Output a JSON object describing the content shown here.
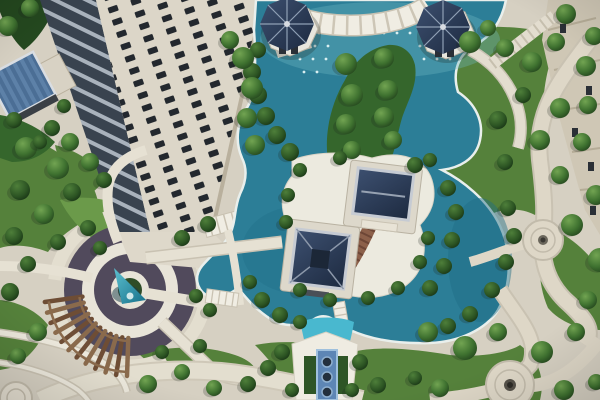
{
  "meta": {
    "description": "Aerial photograph of a residential complex courtyard with teal ornamental ponds, two navy-roofed pavilions on a central island, two octagonal gazebos, a circular garden plaza with a teal cone fountain, a curved wooden pergola, winding stone walkways and a cream high-rise tower at the upper left"
  },
  "palette": {
    "paving": "#d6d0c2",
    "paving_light": "#eceadf",
    "paving_band": "#c9c2b2",
    "paving_dark": "#b5ac99",
    "lawn": "#55813b",
    "lawn_light": "#6b9a4a",
    "foliage_dark": "#24481f",
    "foliage": "#35662c",
    "plant_purple": "#514a5c",
    "plant_inner": "#2f4d28",
    "water": "#2c7e97",
    "water_deep": "#1f6c86",
    "water_light": "#6fb6c2",
    "water_cyan": "#49b8cf",
    "coping": "#e9efec",
    "roof_navy": "#26354e",
    "roof_ridge": "#c6cbd3",
    "building_face": "#dcd6c8",
    "building_side": "#cfc7b5",
    "window": "#23282e",
    "balcony_glass": "#39434f",
    "balcony_slab": "#a9b2bc",
    "panel_blue": "#5d81a8",
    "panel_blue_dark": "#4b6e95",
    "wood": "#6e4d35",
    "wood_light": "#8a6a4c",
    "terracotta": "#8c604a",
    "step_shadow": "#6d4636",
    "feature_blue": "#5d86b5",
    "feature_rim": "#9fc0dd",
    "pot_dark": "#23303e",
    "inset_green": "#2e5526",
    "shadow": "#1c241c"
  },
  "scene": {
    "trees": [
      {
        "x": 346,
        "y": 64,
        "r": 11,
        "k": "t"
      },
      {
        "x": 384,
        "y": 58,
        "r": 10,
        "k": "t"
      },
      {
        "x": 352,
        "y": 95,
        "r": 11,
        "k": "t"
      },
      {
        "x": 388,
        "y": 90,
        "r": 10,
        "k": "t"
      },
      {
        "x": 346,
        "y": 124,
        "r": 10,
        "k": "t"
      },
      {
        "x": 384,
        "y": 117,
        "r": 10,
        "k": "t"
      },
      {
        "x": 352,
        "y": 150,
        "r": 9,
        "k": "t"
      },
      {
        "x": 393,
        "y": 140,
        "r": 9,
        "k": "t"
      },
      {
        "x": 258,
        "y": 50,
        "r": 8,
        "k": "b"
      },
      {
        "x": 252,
        "y": 72,
        "r": 9,
        "k": "b"
      },
      {
        "x": 258,
        "y": 95,
        "r": 9,
        "k": "b"
      },
      {
        "x": 266,
        "y": 116,
        "r": 9,
        "k": "b"
      },
      {
        "x": 277,
        "y": 135,
        "r": 9,
        "k": "b"
      },
      {
        "x": 290,
        "y": 152,
        "r": 9,
        "k": "b"
      },
      {
        "x": 243,
        "y": 58,
        "r": 11,
        "k": "t"
      },
      {
        "x": 252,
        "y": 88,
        "r": 11,
        "k": "t"
      },
      {
        "x": 247,
        "y": 118,
        "r": 10,
        "k": "t"
      },
      {
        "x": 255,
        "y": 145,
        "r": 10,
        "k": "t"
      },
      {
        "x": 230,
        "y": 40,
        "r": 9,
        "k": "t"
      },
      {
        "x": 470,
        "y": 42,
        "r": 11,
        "k": "t"
      },
      {
        "x": 488,
        "y": 28,
        "r": 8,
        "k": "t"
      },
      {
        "x": 505,
        "y": 48,
        "r": 9,
        "k": "t"
      },
      {
        "x": 532,
        "y": 62,
        "r": 10,
        "k": "t"
      },
      {
        "x": 556,
        "y": 42,
        "r": 9,
        "k": "t"
      },
      {
        "x": 586,
        "y": 66,
        "r": 10,
        "k": "t"
      },
      {
        "x": 523,
        "y": 95,
        "r": 8,
        "k": "b"
      },
      {
        "x": 560,
        "y": 108,
        "r": 10,
        "k": "t"
      },
      {
        "x": 498,
        "y": 120,
        "r": 9,
        "k": "b"
      },
      {
        "x": 540,
        "y": 140,
        "r": 10,
        "k": "t"
      },
      {
        "x": 582,
        "y": 142,
        "r": 9,
        "k": "t"
      },
      {
        "x": 505,
        "y": 162,
        "r": 8,
        "k": "b"
      },
      {
        "x": 560,
        "y": 175,
        "r": 9,
        "k": "t"
      },
      {
        "x": 566,
        "y": 14,
        "r": 10,
        "k": "t"
      },
      {
        "x": 594,
        "y": 36,
        "r": 9,
        "k": "t"
      },
      {
        "x": 588,
        "y": 105,
        "r": 9,
        "k": "t"
      },
      {
        "x": 596,
        "y": 195,
        "r": 10,
        "k": "t"
      },
      {
        "x": 572,
        "y": 225,
        "r": 11,
        "k": "t"
      },
      {
        "x": 600,
        "y": 260,
        "r": 12,
        "k": "t"
      },
      {
        "x": 588,
        "y": 300,
        "r": 9,
        "k": "t"
      },
      {
        "x": 448,
        "y": 188,
        "r": 8,
        "k": "b"
      },
      {
        "x": 456,
        "y": 212,
        "r": 8,
        "k": "b"
      },
      {
        "x": 452,
        "y": 240,
        "r": 8,
        "k": "b"
      },
      {
        "x": 444,
        "y": 266,
        "r": 8,
        "k": "b"
      },
      {
        "x": 430,
        "y": 288,
        "r": 8,
        "k": "b"
      },
      {
        "x": 508,
        "y": 208,
        "r": 8,
        "k": "b"
      },
      {
        "x": 514,
        "y": 236,
        "r": 8,
        "k": "b"
      },
      {
        "x": 506,
        "y": 262,
        "r": 8,
        "k": "b"
      },
      {
        "x": 492,
        "y": 290,
        "r": 8,
        "k": "b"
      },
      {
        "x": 470,
        "y": 314,
        "r": 8,
        "k": "b"
      },
      {
        "x": 448,
        "y": 326,
        "r": 8,
        "k": "b"
      },
      {
        "x": 300,
        "y": 170,
        "r": 7,
        "k": "b"
      },
      {
        "x": 288,
        "y": 195,
        "r": 7,
        "k": "b"
      },
      {
        "x": 286,
        "y": 222,
        "r": 7,
        "k": "b"
      },
      {
        "x": 300,
        "y": 290,
        "r": 7,
        "k": "b"
      },
      {
        "x": 330,
        "y": 300,
        "r": 7,
        "k": "b"
      },
      {
        "x": 368,
        "y": 298,
        "r": 7,
        "k": "b"
      },
      {
        "x": 398,
        "y": 288,
        "r": 7,
        "k": "b"
      },
      {
        "x": 420,
        "y": 262,
        "r": 7,
        "k": "b"
      },
      {
        "x": 428,
        "y": 238,
        "r": 7,
        "k": "b"
      },
      {
        "x": 340,
        "y": 158,
        "r": 7,
        "k": "b"
      },
      {
        "x": 415,
        "y": 165,
        "r": 8,
        "k": "b"
      },
      {
        "x": 430,
        "y": 160,
        "r": 7,
        "k": "b"
      },
      {
        "x": 262,
        "y": 300,
        "r": 8,
        "k": "b"
      },
      {
        "x": 280,
        "y": 315,
        "r": 8,
        "k": "b"
      },
      {
        "x": 300,
        "y": 322,
        "r": 7,
        "k": "b"
      },
      {
        "x": 250,
        "y": 282,
        "r": 7,
        "k": "b"
      },
      {
        "x": 210,
        "y": 310,
        "r": 7,
        "k": "b"
      },
      {
        "x": 196,
        "y": 296,
        "r": 7,
        "k": "b"
      },
      {
        "x": 428,
        "y": 332,
        "r": 10,
        "k": "t"
      },
      {
        "x": 465,
        "y": 348,
        "r": 12,
        "k": "t"
      },
      {
        "x": 498,
        "y": 332,
        "r": 9,
        "k": "t"
      },
      {
        "x": 542,
        "y": 352,
        "r": 11,
        "k": "t"
      },
      {
        "x": 576,
        "y": 332,
        "r": 9,
        "k": "t"
      },
      {
        "x": 564,
        "y": 390,
        "r": 10,
        "k": "t"
      },
      {
        "x": 596,
        "y": 382,
        "r": 8,
        "k": "t"
      },
      {
        "x": 440,
        "y": 388,
        "r": 9,
        "k": "t"
      },
      {
        "x": 415,
        "y": 378,
        "r": 7,
        "k": "b"
      },
      {
        "x": 282,
        "y": 352,
        "r": 8,
        "k": "b"
      },
      {
        "x": 268,
        "y": 368,
        "r": 8,
        "k": "b"
      },
      {
        "x": 292,
        "y": 390,
        "r": 7,
        "k": "b"
      },
      {
        "x": 360,
        "y": 362,
        "r": 8,
        "k": "b"
      },
      {
        "x": 378,
        "y": 385,
        "r": 8,
        "k": "b"
      },
      {
        "x": 352,
        "y": 390,
        "r": 7,
        "k": "b"
      },
      {
        "x": 26,
        "y": 148,
        "r": 11,
        "k": "t"
      },
      {
        "x": 58,
        "y": 168,
        "r": 11,
        "k": "t"
      },
      {
        "x": 20,
        "y": 190,
        "r": 10,
        "k": "b"
      },
      {
        "x": 72,
        "y": 192,
        "r": 9,
        "k": "b"
      },
      {
        "x": 44,
        "y": 214,
        "r": 10,
        "k": "t"
      },
      {
        "x": 88,
        "y": 228,
        "r": 8,
        "k": "b"
      },
      {
        "x": 14,
        "y": 236,
        "r": 9,
        "k": "b"
      },
      {
        "x": 58,
        "y": 242,
        "r": 8,
        "k": "b"
      },
      {
        "x": 28,
        "y": 264,
        "r": 8,
        "k": "b"
      },
      {
        "x": 10,
        "y": 292,
        "r": 9,
        "k": "b"
      },
      {
        "x": 100,
        "y": 248,
        "r": 7,
        "k": "b"
      },
      {
        "x": 182,
        "y": 238,
        "r": 8,
        "k": "b"
      },
      {
        "x": 208,
        "y": 224,
        "r": 8,
        "k": "b"
      },
      {
        "x": 38,
        "y": 332,
        "r": 9,
        "k": "t"
      },
      {
        "x": 18,
        "y": 356,
        "r": 8,
        "k": "t"
      },
      {
        "x": 148,
        "y": 384,
        "r": 9,
        "k": "t"
      },
      {
        "x": 182,
        "y": 372,
        "r": 8,
        "k": "t"
      },
      {
        "x": 214,
        "y": 388,
        "r": 8,
        "k": "t"
      },
      {
        "x": 248,
        "y": 384,
        "r": 8,
        "k": "b"
      },
      {
        "x": 162,
        "y": 352,
        "r": 7,
        "k": "b"
      },
      {
        "x": 200,
        "y": 346,
        "r": 7,
        "k": "b"
      },
      {
        "x": 8,
        "y": 26,
        "r": 10,
        "k": "t"
      },
      {
        "x": 30,
        "y": 8,
        "r": 9,
        "k": "t"
      },
      {
        "x": 14,
        "y": 120,
        "r": 8,
        "k": "b"
      },
      {
        "x": 52,
        "y": 128,
        "r": 8,
        "k": "b"
      },
      {
        "x": 70,
        "y": 142,
        "r": 9,
        "k": "t"
      },
      {
        "x": 64,
        "y": 106,
        "r": 7,
        "k": "b"
      },
      {
        "x": 90,
        "y": 162,
        "r": 9,
        "k": "t"
      },
      {
        "x": 104,
        "y": 180,
        "r": 8,
        "k": "b"
      },
      {
        "x": 40,
        "y": 142,
        "r": 7,
        "k": "b"
      }
    ],
    "fountain_jets": {
      "radius": 1.4,
      "step": 13,
      "rows": [
        {
          "y": 20,
          "x0": 318,
          "x1": 452
        },
        {
          "y": 33,
          "x0": 306,
          "x1": 462
        },
        {
          "y": 46,
          "x0": 302,
          "x1": 330
        },
        {
          "y": 46,
          "x0": 420,
          "x1": 464
        },
        {
          "y": 59,
          "x0": 300,
          "x1": 328
        },
        {
          "y": 59,
          "x0": 424,
          "x1": 460
        },
        {
          "y": 72,
          "x0": 304,
          "x1": 326
        }
      ]
    },
    "pergola": {
      "cx": 130,
      "cy": 290,
      "r1": 48,
      "r2": 86,
      "a0": 92,
      "a1": 172,
      "slats": 12
    }
  }
}
